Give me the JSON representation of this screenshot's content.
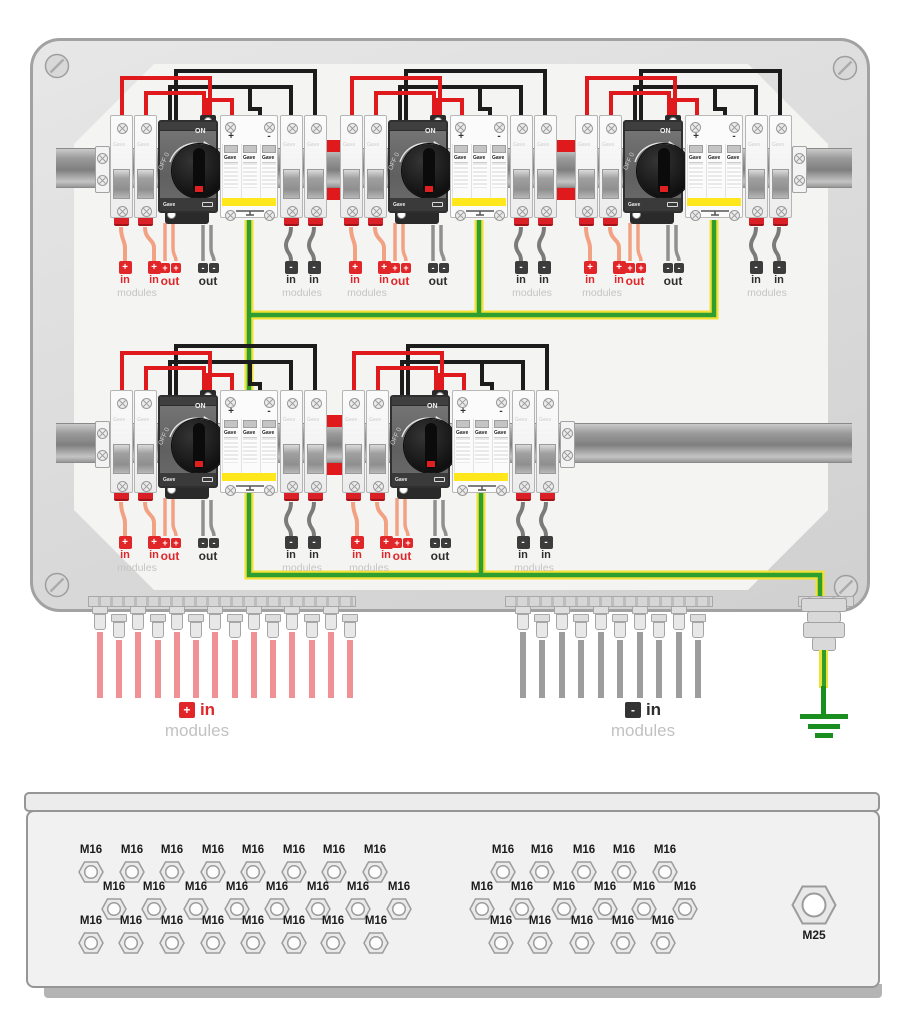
{
  "brand": "Gave",
  "enclosure": {
    "switch": {
      "on_label": "ON",
      "off_label": "OFF 0"
    },
    "spd": {
      "plus_label": "+",
      "minus_label": "-"
    },
    "labels": {
      "in": "in",
      "out": "out",
      "modules": "modules",
      "plus": "+",
      "minus": "-"
    },
    "bottom": {
      "plus": "+",
      "minus": "-",
      "plus_in": "in",
      "plus_modules": "modules",
      "minus_in": "in",
      "minus_modules": "modules"
    },
    "wires": {
      "positive_in_count": 14,
      "negative_in_count": 10
    },
    "layout": {
      "top_row_groups": 3,
      "bottom_row_groups": 2
    }
  },
  "gland_plate": {
    "m16_label": "M16",
    "m25_label": "M25",
    "left_rows": [
      8,
      8,
      8
    ],
    "right_rows": [
      5,
      6,
      5
    ]
  },
  "colors": {
    "positive": "#e0191d",
    "negative": "#1c1c1c",
    "module_in": "#f2a183",
    "out_negative": "#909090",
    "in_negative": "#7b7b7b",
    "earth_green": "#2f9e31",
    "earth_yellow": "#f2e033",
    "pink_bundle": "#f09195",
    "gray_bundle": "#9d9d9d",
    "terminal_red": "#e02629",
    "terminal_dark": "#3c3c3c"
  }
}
